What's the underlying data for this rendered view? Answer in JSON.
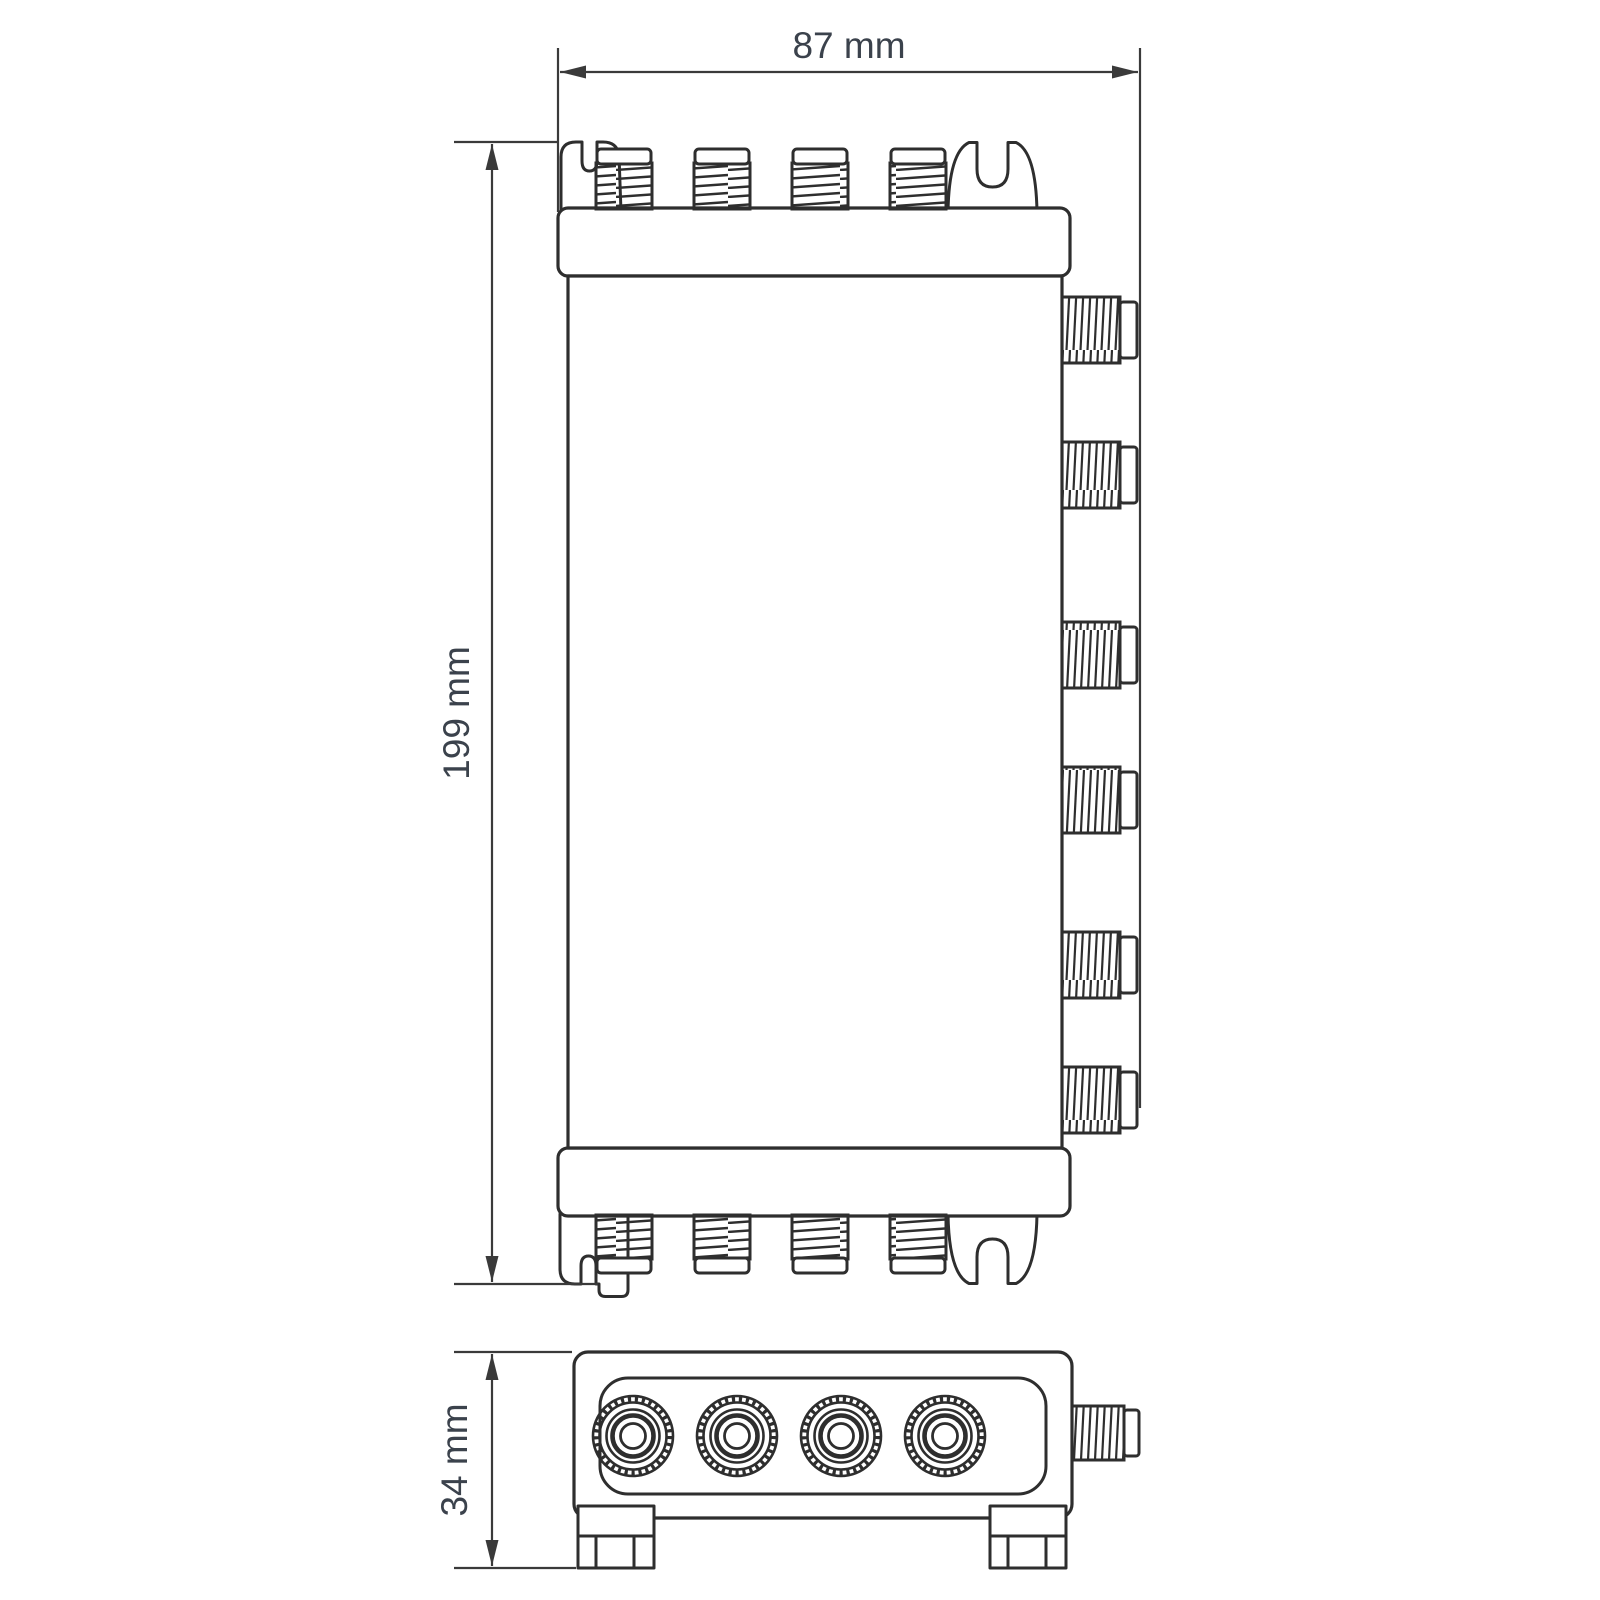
{
  "dimensions": {
    "width": "87 mm",
    "height": "199 mm",
    "depth": "34 mm"
  },
  "colors": {
    "background": "#ffffff",
    "device_line": "#2e2e2e",
    "dimension_line": "#3a3a3a",
    "label_text": "#3b424c"
  },
  "views": {
    "front": {
      "top_connector_count": 4,
      "bottom_connector_count": 4,
      "side_connector_count": 6,
      "mounting_tab_count": 4
    },
    "bottom": {
      "face_connector_count": 4,
      "side_connector_count": 1,
      "mounting_foot_count": 2
    }
  }
}
